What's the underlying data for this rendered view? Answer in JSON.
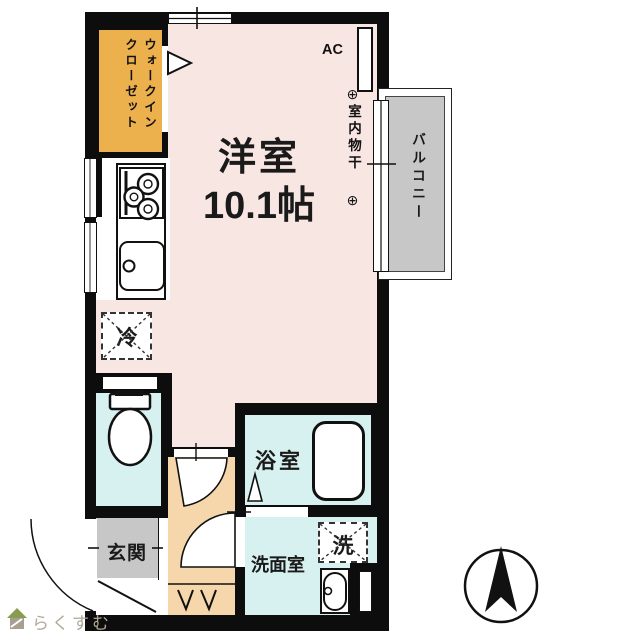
{
  "floorplan": {
    "main_room": {
      "name": "洋室",
      "size": "10.1帖"
    },
    "walk_in_closet": {
      "line1": "ウォークイン",
      "line2": "クローゼット"
    },
    "balcony": {
      "label": "バルコニー"
    },
    "ac": {
      "label": "AC"
    },
    "indoor_drying": {
      "label": "室内物干",
      "symbol": "⊕"
    },
    "refrigerator": {
      "label": "冷"
    },
    "bathroom": {
      "label": "浴室"
    },
    "laundry": {
      "label": "洗"
    },
    "washroom": {
      "label": "洗面室"
    },
    "entrance": {
      "label": "玄関"
    },
    "colors": {
      "wall": "#0d0d0d",
      "main_room_fill": "#f8e6e3",
      "wet_area_fill": "#d6f1ef",
      "hallway_fill": "#f6d7ab",
      "closet_fill": "#ecb14c",
      "gray_fill": "#c7c7c7"
    }
  },
  "branding": {
    "logo_text": "らくすむ"
  }
}
